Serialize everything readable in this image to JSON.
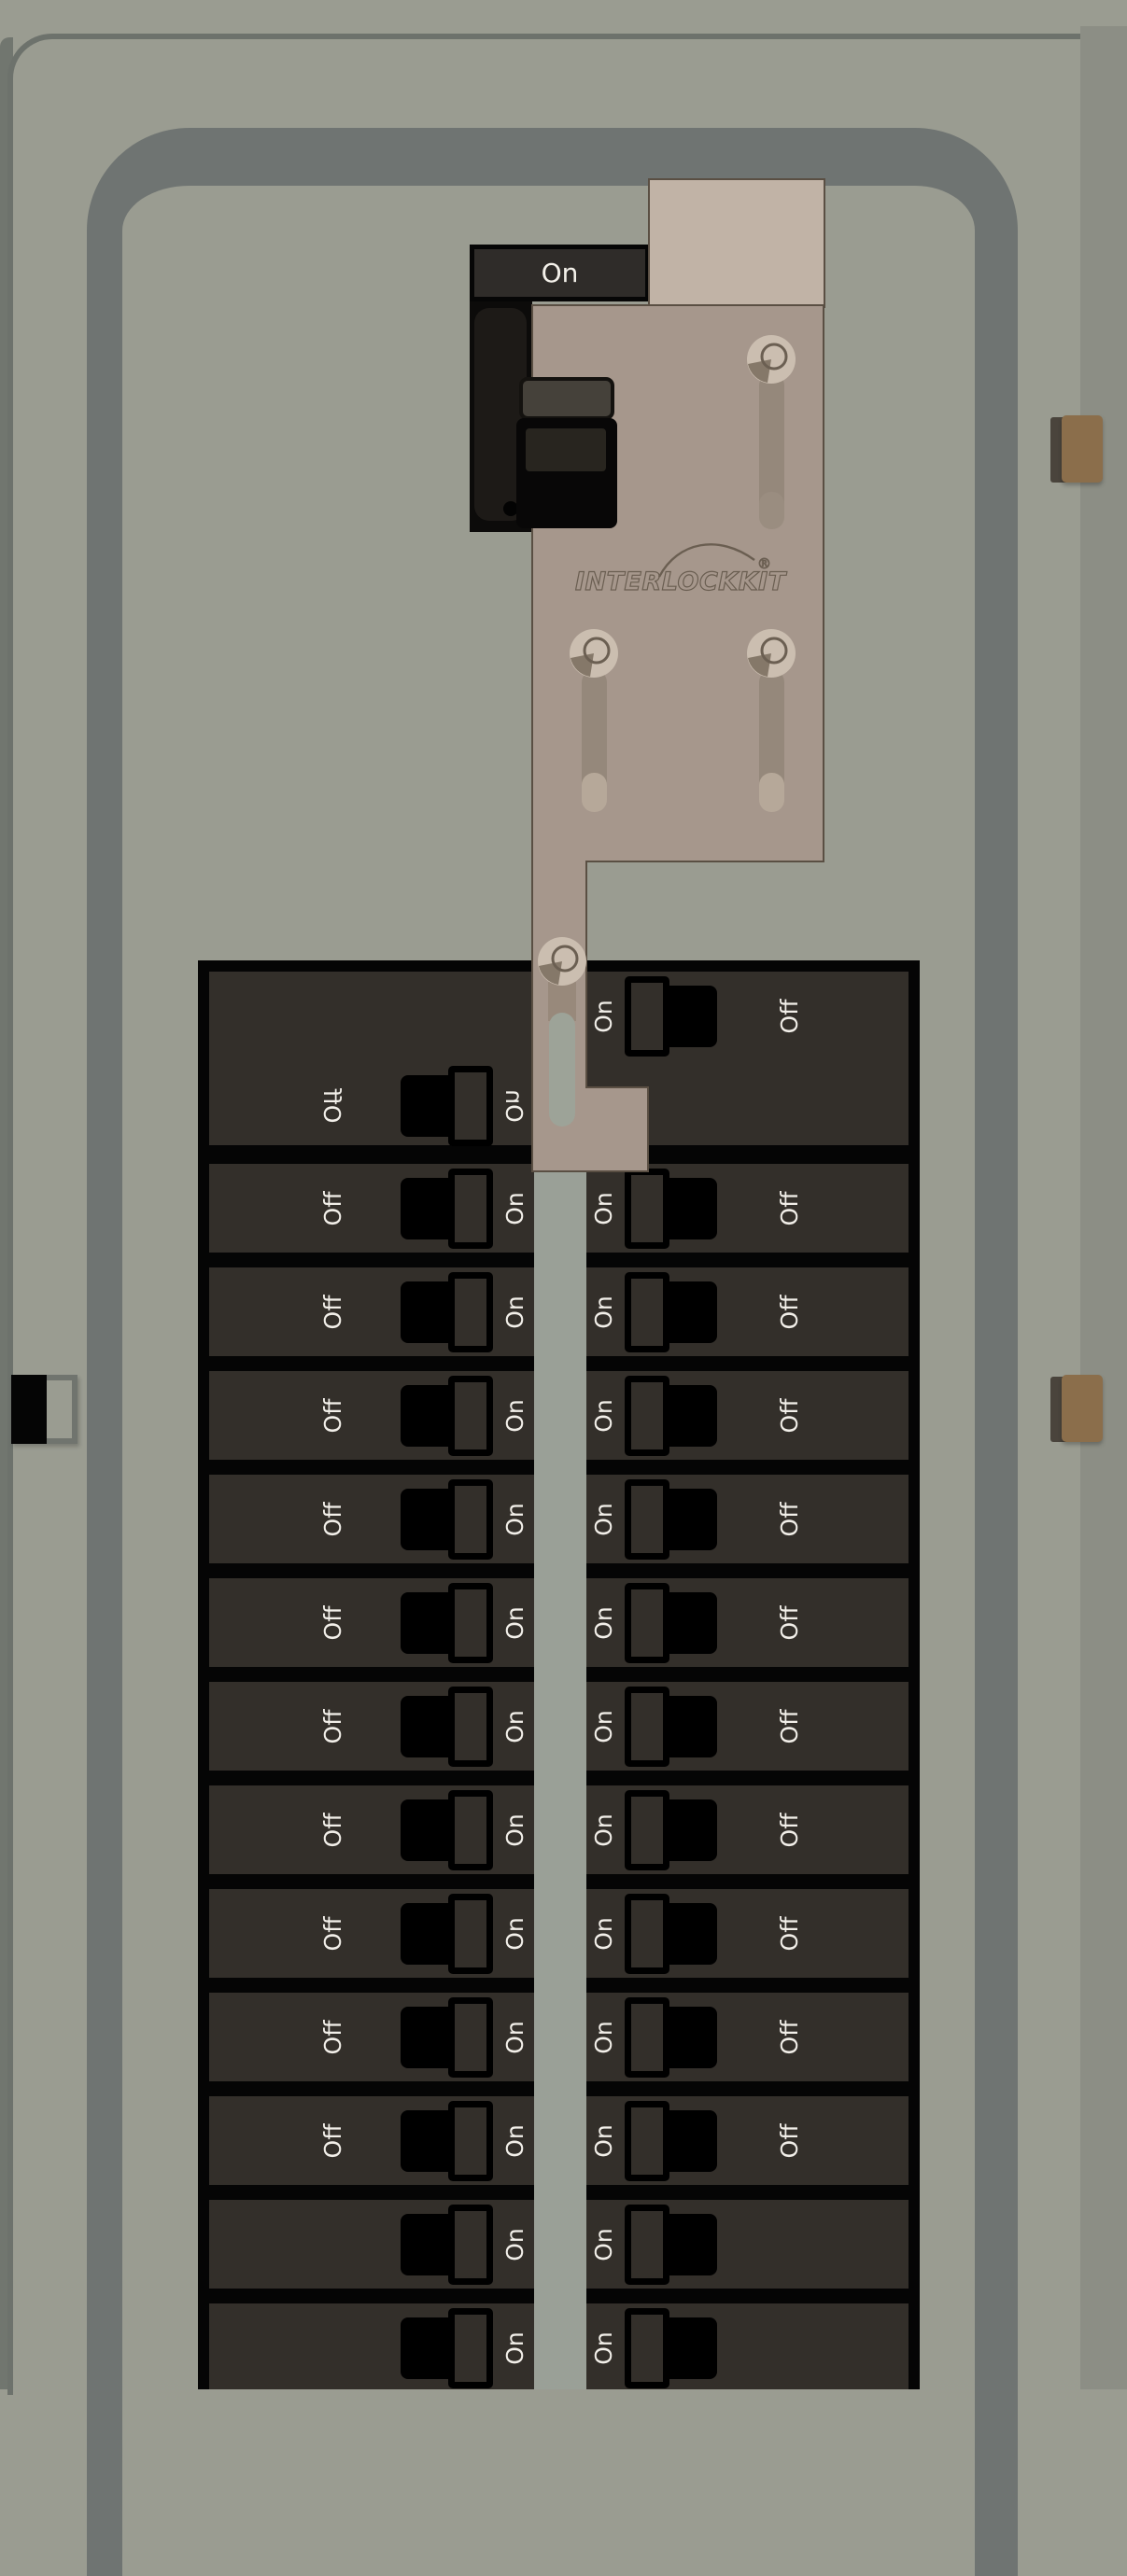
{
  "main_breaker": {
    "label": "On"
  },
  "interlock": {
    "brand": "INTERLOCKKIT",
    "registered": "®"
  },
  "panel": {
    "rows": [
      {
        "tall": true,
        "left_mirrored": true,
        "left": {
          "outer": "Off",
          "inner": "On"
        },
        "right": {
          "inner": "On",
          "outer": "Off"
        }
      },
      {
        "left": {
          "outer": "Off",
          "inner": "On"
        },
        "right": {
          "inner": "On",
          "outer": "Off"
        }
      },
      {
        "left": {
          "outer": "Off",
          "inner": "On"
        },
        "right": {
          "inner": "On",
          "outer": "Off"
        }
      },
      {
        "left": {
          "outer": "Off",
          "inner": "On"
        },
        "right": {
          "inner": "On",
          "outer": "Off"
        }
      },
      {
        "left": {
          "outer": "Off",
          "inner": "On"
        },
        "right": {
          "inner": "On",
          "outer": "Off"
        }
      },
      {
        "left": {
          "outer": "Off",
          "inner": "On"
        },
        "right": {
          "inner": "On",
          "outer": "Off"
        }
      },
      {
        "left": {
          "outer": "Off",
          "inner": "On"
        },
        "right": {
          "inner": "On",
          "outer": "Off"
        }
      },
      {
        "left": {
          "outer": "Off",
          "inner": "On"
        },
        "right": {
          "inner": "On",
          "outer": "Off"
        }
      },
      {
        "left": {
          "outer": "Off",
          "inner": "On"
        },
        "right": {
          "inner": "On",
          "outer": "Off"
        }
      },
      {
        "left": {
          "outer": "Off",
          "inner": "On"
        },
        "right": {
          "inner": "On",
          "outer": "Off"
        }
      },
      {
        "left": {
          "outer": "Off",
          "inner": "On"
        },
        "right": {
          "inner": "On",
          "outer": "Off"
        }
      },
      {
        "left": {
          "inner": "On"
        },
        "right": {
          "inner": "On"
        }
      },
      {
        "left": {
          "inner": "On"
        },
        "right": {
          "inner": "On"
        }
      }
    ]
  },
  "colors": {
    "panel_face": "#9a9c91",
    "door_frame": "#6f7472",
    "right_shade": "#8c8e85",
    "breaker_dark": "#332f2a",
    "matrix_black": "#050505",
    "center_gap": "#9aa097",
    "label_text": "#f2efe9",
    "plate_tan": "#a6978c",
    "plate_light": "#c1b3a6",
    "plate_outline": "#5a4f43",
    "screw_washer": "#cbbeb0",
    "slot": "#95887b",
    "slot_cap": "#b6a899",
    "clip_brown": "#8b6e4b",
    "main_breaker_black": "#0c0b0a",
    "logo_outline": "#6a5e51"
  }
}
